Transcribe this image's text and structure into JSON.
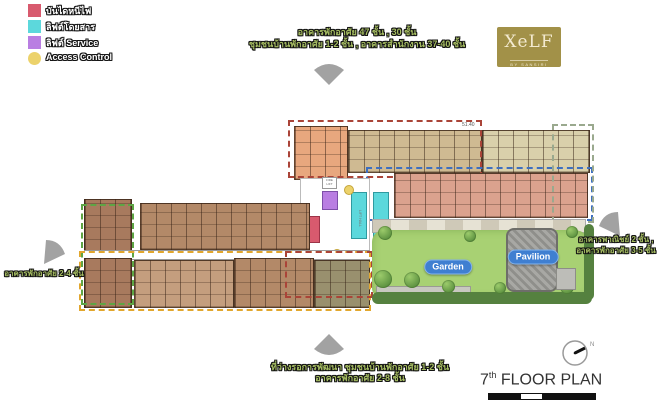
{
  "legend": {
    "items": [
      {
        "label": "บันไดหนีไฟ",
        "color": "#d85a6e",
        "shape": "square"
      },
      {
        "label": "ลิฟต์โดยสาร",
        "color": "#5cd8dc",
        "shape": "square"
      },
      {
        "label": "ลิฟต์ Service",
        "color": "#b97ee2",
        "shape": "square"
      },
      {
        "label": "Access Control",
        "color": "#ecd26b",
        "shape": "circle"
      }
    ]
  },
  "annotations": {
    "top": {
      "line1": "อาคารพักอาศัย 47 ชั้น , 30 ชั้น",
      "line2": "ชุมชนบ้านพักอาศัย 1-2 ชั้น , อาคารสำนักงาน 37-40 ชั้น"
    },
    "right": {
      "line1": "อาคารพาณิชย์ 2 ชั้น ,",
      "line2": "อาคารพักอาศัย 3-5 ชั้น"
    },
    "left": {
      "line1": "อาคารพักอาศัย 2-4 ชั้น"
    },
    "bottom": {
      "line1": "ที่ว่างรอการพัฒนา ชุมชนบ้านพักอาศัย 1-2 ชั้น",
      "line2": "อาคารพักอาศัย 2-8 ชั้น"
    }
  },
  "logo": {
    "brand": "XeLF",
    "sub": "BY SANSIRI",
    "bg_color": "#a29148"
  },
  "plan": {
    "garden_label": "Garden",
    "pavilion_label": "Pavilion",
    "lift_hall_label": "LIFT HALL",
    "fire_lift_label": "FIRE LIFT",
    "dim_label": "51.40",
    "zone_colors": {
      "green": "#5ea544",
      "orange": "#e2a72e",
      "red": "#aa4438",
      "blue": "#3d6fc0",
      "sage": "#9aa98e"
    },
    "element_colors": {
      "fire_stair": "#d85a6e",
      "passenger_lift": "#5cd8dc",
      "service_lift": "#b97ee2",
      "access_control": "#ecd26b"
    }
  },
  "footer": {
    "floor_number": "7",
    "floor_suffix": "th",
    "title": "FLOOR PLAN",
    "compass_n": "N"
  }
}
